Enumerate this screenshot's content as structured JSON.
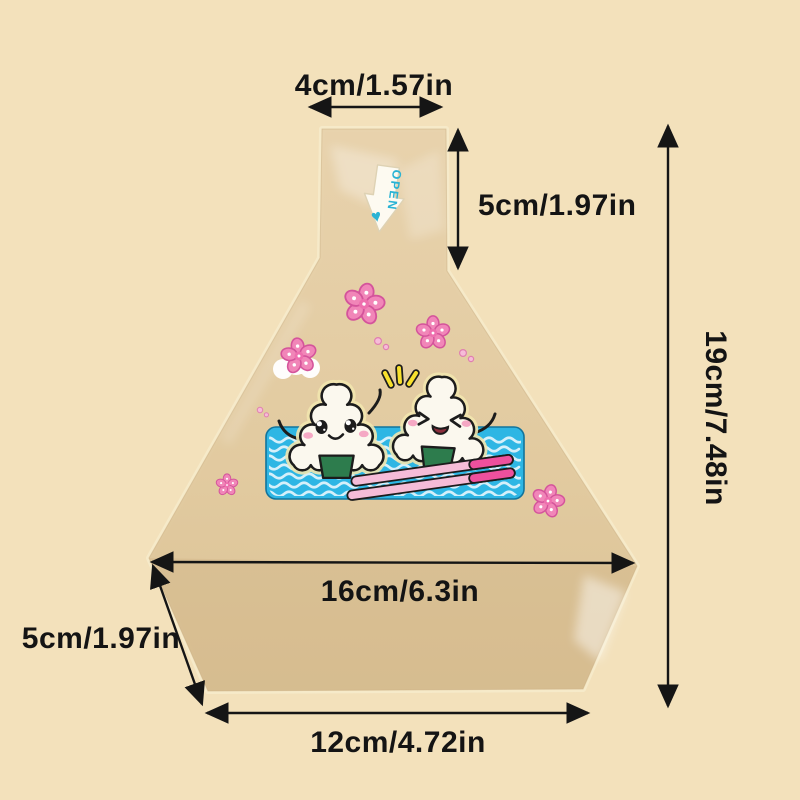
{
  "image": {
    "description": "Product dimension diagram of a transparent triangle onigiri (rice ball) packaging bag on a cream background",
    "background_color": "#f3e1bb"
  },
  "bag": {
    "open_tab_label": "OPEN",
    "tint_color": "#e2cba1",
    "illustration": {
      "characters": "two cute onigiri rice balls on a blue picnic mat",
      "mat_color": "#2eb6e4",
      "nori_color": "#2d7c4d",
      "chopsticks_color": "#ee509d",
      "flower_color": "#f186b8",
      "sparkle_color": "#f7e02d",
      "open_tab_accent": "#2ab3d4"
    }
  },
  "dimensions": {
    "top_width": "4cm/1.57in",
    "neck_height": "5cm/1.97in",
    "total_height": "19cm/7.48in",
    "max_width": "16cm/6.3in",
    "side_edge": "5cm/1.97in",
    "bottom_width": "12cm/4.72in"
  }
}
